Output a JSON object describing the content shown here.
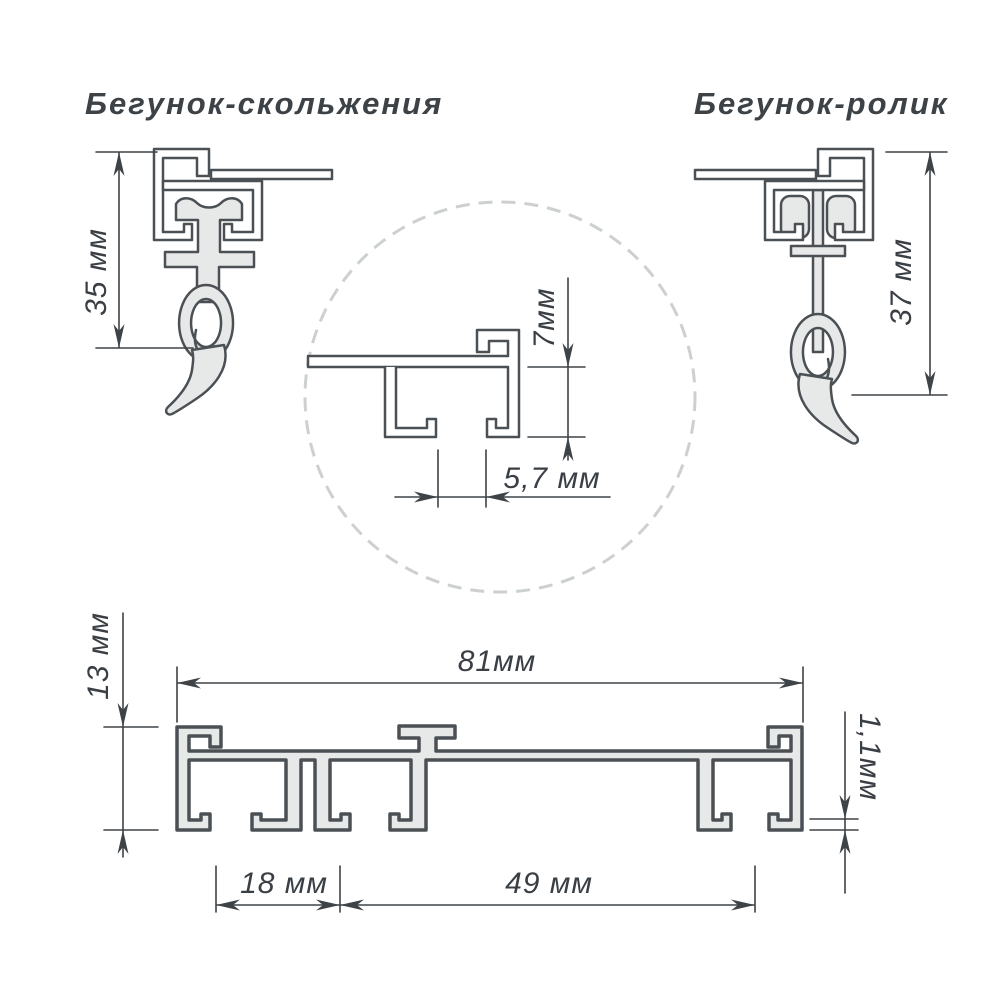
{
  "titles": {
    "left": "Бегунок-скольжения",
    "right": "Бегунок-ролик"
  },
  "dimensions": {
    "runner_glide_height": "35 мм",
    "runner_roller_height": "37 мм",
    "detail_channel_depth": "7мм",
    "detail_slot_width": "5,7 мм",
    "profile_height": "13 мм",
    "profile_width": "81мм",
    "wall_thickness": "1,1мм",
    "left_channel_width": "18 мм",
    "right_channel_width": "49 мм"
  },
  "colors": {
    "background": "#ffffff",
    "line": "#4b5055",
    "metal_fill": "#e7e9e9",
    "dimension_line": "#3e4347",
    "text": "#3a3f45",
    "zoom_circle_dash": "#cdd0d1"
  }
}
